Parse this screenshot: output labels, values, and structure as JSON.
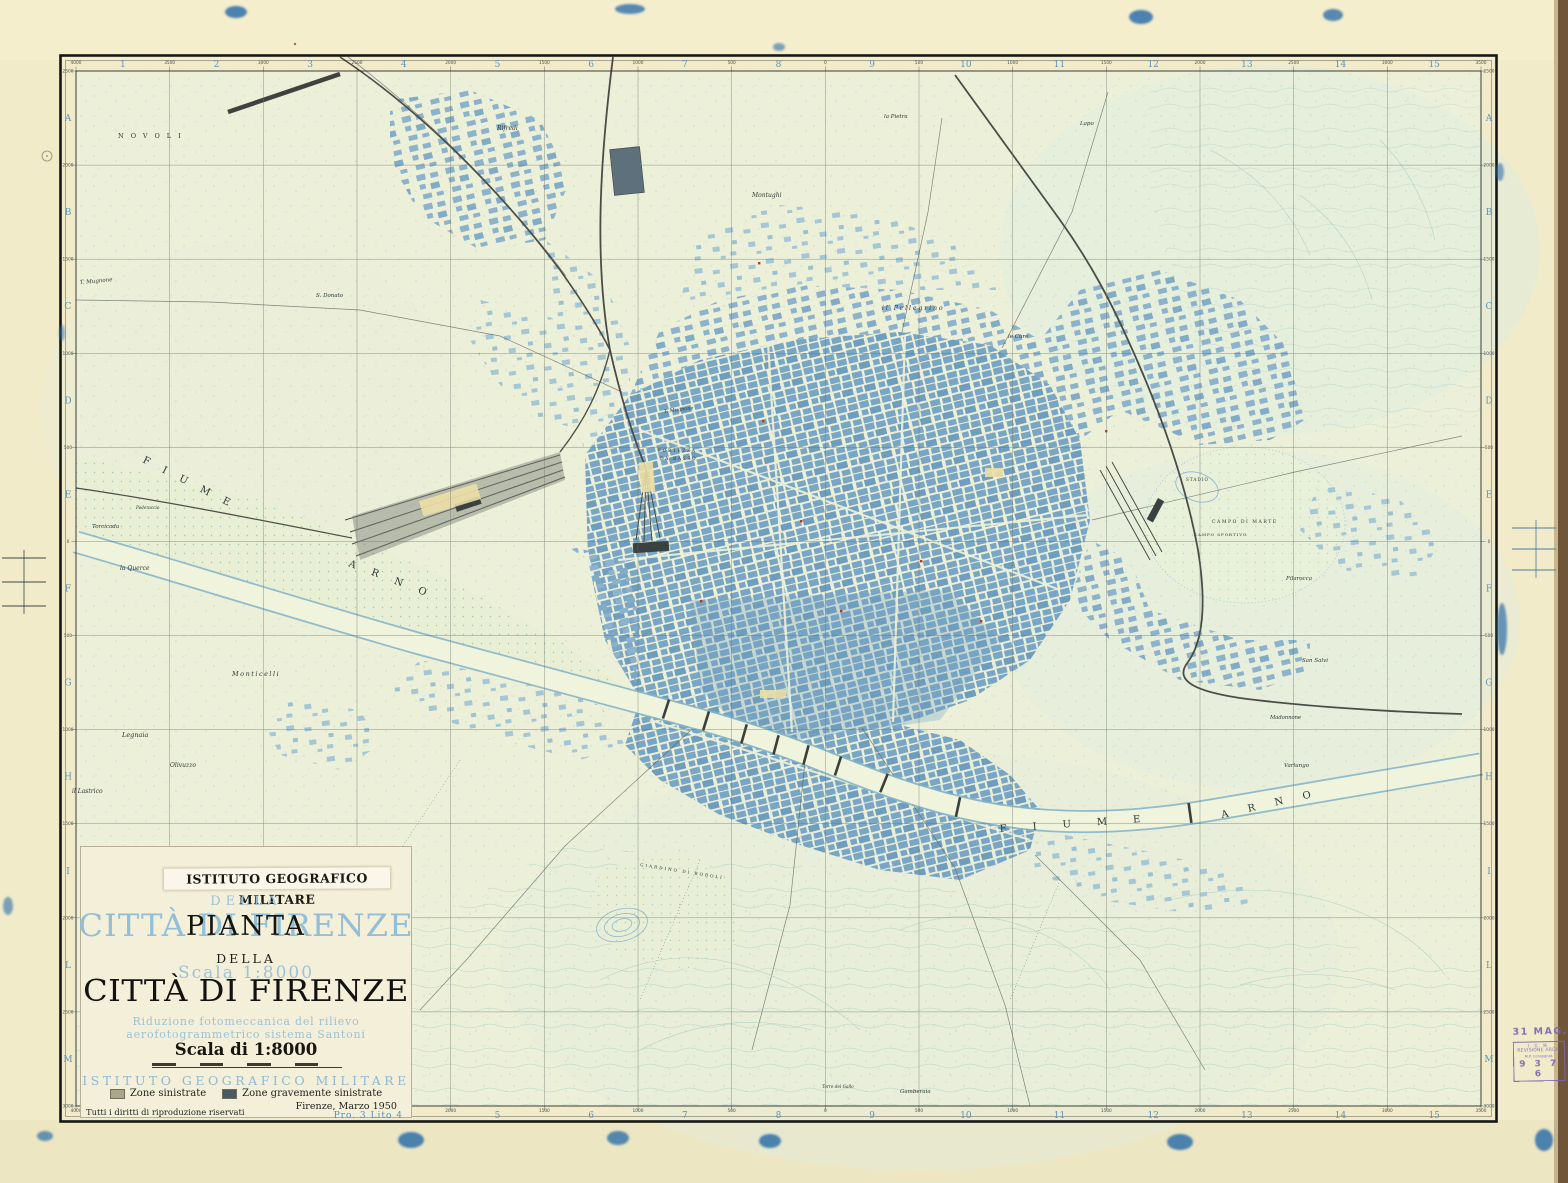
{
  "title_block": {
    "header_strip": "ISTITUTO GEOGRAFICO MILITARE",
    "ghost_della": "DELLA",
    "ghost_title": "CITTÀ DI FIRENZE",
    "ghost_scale": "Scala 1:8000",
    "black_pianta": "PIANTA",
    "black_della": "DELLA",
    "black_title": "CITTÀ DI FIRENZE",
    "ghost_note1": "Riduzione fotomeccanica del rilievo",
    "ghost_note2": "aerofotogrammetrico sistema Santoni",
    "scale_text": "Scala di 1:8000",
    "ghost_institute": "ISTITUTO GEOGRAFICO MILITARE",
    "legend": [
      {
        "label": "Zone sinistrate",
        "color": "#a9a78c"
      },
      {
        "label": "Zone gravemente sinistrate",
        "color": "#4a5a60"
      }
    ],
    "rights": "Tutti i diritti di riproduzione riservati",
    "imprint_date": "Firenze, Marzo 1950",
    "imprint_litho": "Pro. 3  Lito 4"
  },
  "stamps": {
    "date_stamp": "31 MAG. 194",
    "box_line1": "I. G. M.",
    "box_line2": "REVISIONE ARCH.",
    "box_line3": "M.P. Consegnat.",
    "box_number": "9 3 7 6"
  },
  "margin": {
    "columns": [
      "1",
      "2",
      "3",
      "4",
      "5",
      "6",
      "7",
      "8",
      "9",
      "10",
      "11",
      "12",
      "13",
      "14",
      "15"
    ],
    "rows": [
      "A",
      "B",
      "C",
      "D",
      "E",
      "F",
      "G",
      "H",
      "I",
      "L",
      "M"
    ],
    "top_coords": [
      "4000",
      "3500",
      "3000",
      "2500",
      "2000",
      "1500",
      "1000",
      "500",
      "0",
      "500",
      "1000",
      "1500",
      "2000",
      "2500",
      "3000",
      "3500"
    ],
    "bottom_coords": [
      "4000",
      "3500",
      "3000",
      "2500",
      "2000",
      "1500",
      "1000",
      "500",
      "0",
      "500",
      "1000",
      "1500",
      "2000",
      "2500",
      "3000",
      "3500"
    ],
    "side_coords": [
      "2500",
      "2000",
      "1500",
      "1000",
      "500",
      "0",
      "500",
      "1000",
      "1500",
      "2000",
      "2500",
      "3000"
    ]
  },
  "map_labels": [
    {
      "t": "NOVOLI",
      "x": 118,
      "y": 138,
      "s": 6.5,
      "sp": 7
    },
    {
      "t": "Rifredi",
      "x": 497,
      "y": 130,
      "s": 6,
      "i": 1
    },
    {
      "t": "S. Donato",
      "x": 316,
      "y": 297,
      "s": 5.5,
      "i": 1
    },
    {
      "t": "T. Mugnone",
      "x": 80,
      "y": 284,
      "s": 5.5,
      "i": 1,
      "r": -5
    },
    {
      "t": "T. Mugnone",
      "x": 664,
      "y": 413,
      "s": 5,
      "i": 1,
      "r": -7
    },
    {
      "t": "Montughi",
      "x": 752,
      "y": 197,
      "s": 6,
      "i": 1
    },
    {
      "t": "la Pietra",
      "x": 884,
      "y": 118,
      "s": 5.5,
      "i": 1
    },
    {
      "t": "Lapo",
      "x": 1080,
      "y": 125,
      "s": 5.5,
      "i": 1
    },
    {
      "t": "il Pellegrino",
      "x": 882,
      "y": 310,
      "s": 6,
      "i": 1,
      "sp": 2
    },
    {
      "t": "le Cure",
      "x": 1008,
      "y": 338,
      "s": 5.5,
      "i": 1
    },
    {
      "t": "FORTEZZA",
      "x": 658,
      "y": 452,
      "s": 4.6,
      "sp": 1.5
    },
    {
      "t": "DA BASSO",
      "x": 660,
      "y": 460,
      "s": 4.6,
      "sp": 1.5
    },
    {
      "t": "FIUME",
      "x": 142,
      "y": 462,
      "s": 10,
      "sp": 15,
      "r": 27
    },
    {
      "t": "ARNO",
      "x": 348,
      "y": 566,
      "s": 10,
      "sp": 17,
      "r": 21
    },
    {
      "t": "Torcicoda",
      "x": 92,
      "y": 528,
      "s": 5.5,
      "i": 1
    },
    {
      "t": "Poderaccio",
      "x": 136,
      "y": 509,
      "s": 4.2,
      "i": 1
    },
    {
      "t": "la Querce",
      "x": 120,
      "y": 570,
      "s": 6,
      "i": 1
    },
    {
      "t": "Monticelli",
      "x": 232,
      "y": 676,
      "s": 6.5,
      "i": 1,
      "sp": 1.5
    },
    {
      "t": "Legnaia",
      "x": 122,
      "y": 737,
      "s": 6.5,
      "i": 1
    },
    {
      "t": "Olivuzzo",
      "x": 170,
      "y": 767,
      "s": 6,
      "i": 1
    },
    {
      "t": "il Lastrico",
      "x": 72,
      "y": 793,
      "s": 6,
      "i": 1
    },
    {
      "t": "STADIO",
      "x": 1186,
      "y": 481,
      "s": 4.2,
      "sp": 1
    },
    {
      "t": "CAMPO DI MARTE",
      "x": 1212,
      "y": 523,
      "s": 4.6,
      "sp": 1.5
    },
    {
      "t": "CAMPO SPORTIVO",
      "x": 1194,
      "y": 536,
      "s": 4,
      "sp": 1
    },
    {
      "t": "Filarocca",
      "x": 1286,
      "y": 580,
      "s": 5.5,
      "i": 1
    },
    {
      "t": "San Salvi",
      "x": 1302,
      "y": 662,
      "s": 5.5,
      "i": 1
    },
    {
      "t": "Madonnone",
      "x": 1270,
      "y": 719,
      "s": 5.2,
      "i": 1
    },
    {
      "t": "Varlungo",
      "x": 1284,
      "y": 767,
      "s": 5.5,
      "i": 1
    },
    {
      "t": "FIUME",
      "x": 1000,
      "y": 832,
      "s": 10,
      "sp": 26,
      "r": -4
    },
    {
      "t": "ARNO",
      "x": 1222,
      "y": 818,
      "s": 10,
      "sp": 20,
      "r": -13
    },
    {
      "t": "GIARDINO DI BOBOLI",
      "x": 640,
      "y": 866,
      "s": 4.2,
      "sp": 2,
      "r": 9
    },
    {
      "t": "Gamberaia",
      "x": 900,
      "y": 1093,
      "s": 5.5,
      "i": 1
    },
    {
      "t": "Torre del Gallo",
      "x": 822,
      "y": 1088,
      "s": 4.2,
      "i": 1
    }
  ],
  "colors": {
    "label_ink": "#2c3734",
    "grid_letter_blue": "#5e93b8",
    "coord_ink": "#45524d"
  }
}
